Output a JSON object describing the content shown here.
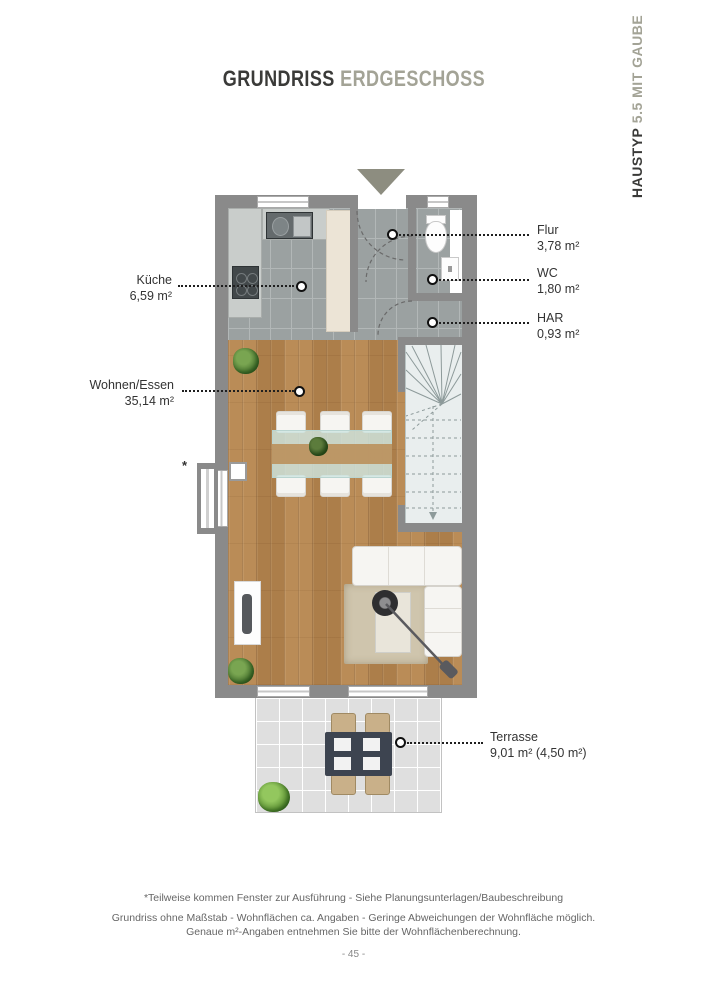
{
  "header": {
    "title_primary": "GRUNDRISS",
    "title_secondary": "ERDGESCHOSS"
  },
  "side_tab": {
    "primary": "HAUSTYP",
    "secondary": "5.5 MIT GAUBE"
  },
  "plan": {
    "rooms": [
      {
        "id": "kueche",
        "name": "Küche",
        "area": "6,59 m²"
      },
      {
        "id": "flur",
        "name": "Flur",
        "area": "3,78 m²"
      },
      {
        "id": "wc",
        "name": "WC",
        "area": "1,80 m²"
      },
      {
        "id": "har",
        "name": "HAR",
        "area": "0,93 m²"
      },
      {
        "id": "wohnen-essen",
        "name": "Wohnen/Essen",
        "area": "35,14 m²"
      },
      {
        "id": "terrasse",
        "name": "Terrasse",
        "area": "9,01 m² (4,50 m²)"
      }
    ],
    "window_note_marker": "*"
  },
  "footer": {
    "footnote": "*Teilweise kommen Fenster zur Ausführung - Siehe Planungsunterlagen/Baubeschreibung",
    "disclaimer_line1": "Grundriss ohne Maßstab - Wohnflächen ca. Angaben - Geringe Abweichungen der Wohnfläche möglich.",
    "disclaimer_line2": "Genaue m²-Angaben entnehmen Sie bitte der Wohnflächenberechnung.",
    "page_number": "- 45 -"
  },
  "colors": {
    "ink": "#3a3a38",
    "accent_olive": "#a3a396",
    "wall": "#8a8a8a",
    "tile_floor": "#9ba1a1",
    "wood_floor": "#b5854f",
    "stair_floor": "#e9eeee",
    "terrace_floor": "#dfdfdf"
  }
}
